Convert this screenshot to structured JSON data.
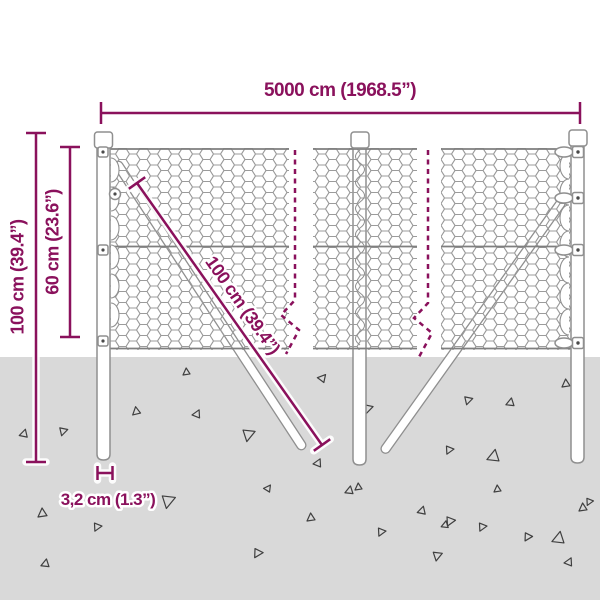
{
  "labels": {
    "width_total": "5000 cm (1968.5”)",
    "height_total": "100 cm (39.4”)",
    "height_mesh": "60 cm (23.6”)",
    "strut_length": "100 cm (39.4”)",
    "post_diameter": "3,2 cm (1.3”)"
  },
  "colors": {
    "dimension": "#8a115c",
    "ground": "#d9d9d9",
    "mesh": "#9b9b9b",
    "wire": "#7f7f7f",
    "post_outline": "#8f8f8f",
    "triangle": "#3f3f3f",
    "background": "#ffffff"
  },
  "ground": {
    "triangles": [
      [
        38,
        508,
        9,
        0
      ],
      [
        22,
        428,
        8,
        20
      ],
      [
        65,
        437,
        8,
        200
      ],
      [
        132,
        407,
        8,
        355
      ],
      [
        196,
        408,
        8,
        30
      ],
      [
        183,
        368,
        7,
        0
      ],
      [
        98,
        533,
        8,
        210
      ],
      [
        43,
        558,
        8,
        15
      ],
      [
        172,
        510,
        13,
        195
      ],
      [
        258,
        560,
        9,
        215
      ],
      [
        307,
        513,
        8,
        0
      ],
      [
        268,
        483,
        7,
        40
      ],
      [
        323,
        372,
        8,
        45
      ],
      [
        370,
        415,
        9,
        200
      ],
      [
        252,
        443,
        12,
        195
      ],
      [
        347,
        485,
        8,
        15
      ],
      [
        382,
        538,
        8,
        210
      ],
      [
        420,
        505,
        8,
        20
      ],
      [
        451,
        528,
        9,
        210
      ],
      [
        440,
        562,
        9,
        195
      ],
      [
        494,
        485,
        7,
        0
      ],
      [
        528,
        543,
        8,
        215
      ],
      [
        555,
        530,
        12,
        15
      ],
      [
        590,
        507,
        7,
        210
      ],
      [
        562,
        379,
        8,
        0
      ],
      [
        508,
        397,
        8,
        15
      ],
      [
        470,
        406,
        8,
        200
      ],
      [
        490,
        448,
        12,
        15
      ],
      [
        450,
        456,
        8,
        210
      ],
      [
        579,
        503,
        8,
        0
      ],
      [
        568,
        556,
        8,
        30
      ],
      [
        483,
        533,
        8,
        210
      ],
      [
        443,
        520,
        7,
        15
      ],
      [
        317,
        457,
        8,
        30
      ],
      [
        355,
        483,
        7,
        0
      ]
    ]
  }
}
